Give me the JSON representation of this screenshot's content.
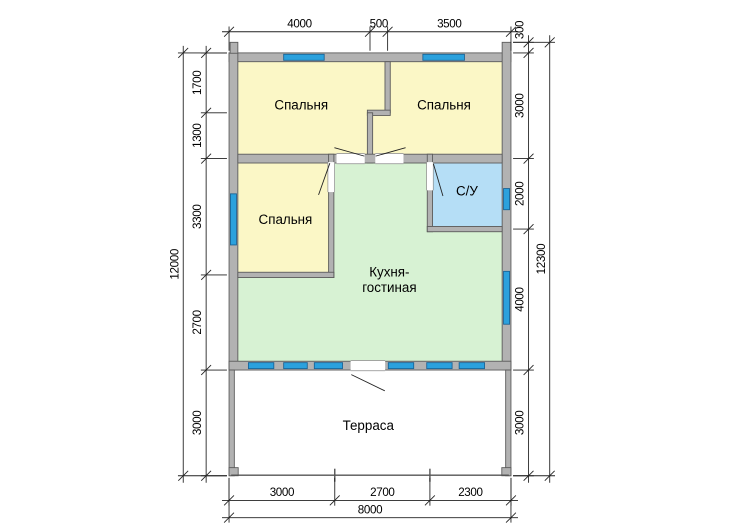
{
  "drawing": {
    "type": "house-floor-plan",
    "units": "mm",
    "colors": {
      "room_yellow": "#fbf7c6",
      "room_green": "#d7f2d3",
      "room_blue": "#b5def6",
      "window_blue": "#2ba1dd",
      "window_outline": "#1a6496",
      "wall_fill": "#b2b2b2",
      "wall_outline": "#5a5a5a",
      "line": "#222222",
      "text": "#000000"
    },
    "rooms": [
      {
        "id": "bedroom-1",
        "label": "Спальня",
        "label_pos": [
          2050,
          1600
        ]
      },
      {
        "id": "bedroom-2",
        "label": "Спальня",
        "label_pos": [
          6100,
          1600
        ]
      },
      {
        "id": "bedroom-3",
        "label": "Спальня",
        "label_pos": [
          1600,
          4850
        ]
      },
      {
        "id": "bathroom",
        "label": "С/У",
        "label_pos": [
          6750,
          4050
        ]
      },
      {
        "id": "kitchen-living",
        "label_lines": [
          "Кухня-",
          "гостиная"
        ],
        "label_pos": [
          4550,
          6350
        ]
      },
      {
        "id": "terrace",
        "label": "Терраса",
        "label_pos": [
          3950,
          10700
        ]
      }
    ],
    "plan": {
      "fills": [
        {
          "name": "bedrooms-top-band",
          "color": "room_yellow",
          "points": "250,250 7750,250 7750,2875 250,2875"
        },
        {
          "name": "bedroom-3",
          "color": "room_yellow",
          "rect": [
            250,
            3125,
            2575,
            3100
          ]
        },
        {
          "name": "kitchen-living",
          "color": "room_green",
          "points": "2975,3125 5625,3125 5625,5075 7750,5075 7750,8750 250,8750 250,6375 2975,6375"
        },
        {
          "name": "bathroom",
          "color": "room_blue",
          "rect": [
            5775,
            3125,
            1975,
            1800
          ]
        }
      ],
      "walls": [
        {
          "rect": [
            0,
            0,
            8000,
            250
          ]
        },
        {
          "rect": [
            0,
            0,
            250,
            9000
          ]
        },
        {
          "rect": [
            7750,
            -300,
            250,
            9300
          ]
        },
        {
          "rect": [
            30,
            -300,
            220,
            310
          ]
        },
        {
          "rect": [
            0,
            8750,
            8000,
            250
          ]
        },
        {
          "rect": [
            4425,
            250,
            150,
            1450
          ]
        },
        {
          "rect": [
            3925,
            1625,
            650,
            150
          ]
        },
        {
          "rect": [
            3925,
            1700,
            150,
            1425
          ]
        },
        {
          "rect": [
            250,
            2875,
            7500,
            250
          ]
        },
        {
          "rect": [
            2825,
            2875,
            150,
            3500
          ]
        },
        {
          "rect": [
            250,
            6225,
            2725,
            150
          ]
        },
        {
          "rect": [
            5625,
            2875,
            150,
            2200
          ]
        },
        {
          "rect": [
            5625,
            4925,
            2125,
            150
          ]
        },
        {
          "rect": [
            0,
            9000,
            150,
            3000
          ]
        },
        {
          "rect": [
            7850,
            9000,
            150,
            3000
          ]
        },
        {
          "rect": [
            0,
            11770,
            260,
            230
          ]
        },
        {
          "rect": [
            7740,
            11770,
            260,
            230
          ]
        }
      ],
      "door_gaps": [
        {
          "rect": [
            3050,
            2855,
            800,
            290
          ]
        },
        {
          "rect": [
            4150,
            2855,
            800,
            290
          ]
        },
        {
          "rect": [
            2805,
            3100,
            190,
            850
          ]
        },
        {
          "rect": [
            5605,
            3100,
            190,
            800
          ]
        },
        {
          "rect": [
            3450,
            8730,
            980,
            290
          ]
        }
      ],
      "windows": [
        {
          "rect": [
            1550,
            40,
            1150,
            170
          ]
        },
        {
          "rect": [
            5500,
            40,
            1180,
            170
          ]
        },
        {
          "rect": [
            40,
            4000,
            170,
            1450
          ]
        },
        {
          "rect": [
            7790,
            3850,
            170,
            600
          ]
        },
        {
          "rect": [
            7790,
            6200,
            170,
            1500
          ]
        },
        {
          "rect": [
            550,
            8790,
            720,
            170
          ]
        },
        {
          "rect": [
            1550,
            8790,
            670,
            170
          ]
        },
        {
          "rect": [
            2420,
            8790,
            800,
            170
          ]
        },
        {
          "rect": [
            4520,
            8790,
            720,
            170
          ]
        },
        {
          "rect": [
            5610,
            8790,
            720,
            170
          ]
        },
        {
          "rect": [
            6530,
            8790,
            720,
            170
          ]
        }
      ],
      "door_swings": [
        {
          "line": [
            2990,
            2690,
            3840,
            2930
          ]
        },
        {
          "line": [
            4160,
            2930,
            5010,
            2690
          ]
        },
        {
          "line": [
            2860,
            3130,
            2540,
            4030
          ]
        },
        {
          "line": [
            5800,
            3150,
            6070,
            4060
          ]
        },
        {
          "line": [
            3470,
            9130,
            4420,
            9590
          ]
        }
      ],
      "terrace": {
        "edge_line": [
          60,
          11985,
          7940,
          11985
        ],
        "post_ticks": [
          3000,
          5700
        ],
        "tick_y": [
          11800,
          12170
        ]
      }
    },
    "dimensions": {
      "chains": [
        {
          "id": "top",
          "axis": "x",
          "line": -600,
          "start": 0,
          "segments": [
            4000,
            500,
            3500
          ],
          "ext_from": -60,
          "ext_to": -750
        },
        {
          "id": "bottom-inner",
          "axis": "x",
          "line": 12700,
          "start": 0,
          "segments": [
            3000,
            2700,
            2300
          ],
          "ext_from": 12060,
          "ext_to": 12850
        },
        {
          "id": "bottom-outer",
          "axis": "x",
          "line": 13190,
          "start": 0,
          "segments": [
            8000
          ],
          "ext_from": 12060,
          "ext_to": 13330
        },
        {
          "id": "left-inner",
          "axis": "y",
          "line": -650,
          "start": 0,
          "segments": [
            1700,
            1300,
            3300,
            2700,
            3000
          ],
          "ext_from": -60,
          "ext_to": -800
        },
        {
          "id": "left-outer",
          "axis": "y",
          "line": -1300,
          "start": 0,
          "segments": [
            12000
          ],
          "ext_from": -60,
          "ext_to": -1450
        },
        {
          "id": "right-inner",
          "axis": "y",
          "line": 8500,
          "start": -300,
          "segments": [
            300,
            3000,
            2000,
            4000,
            3000
          ],
          "ext_from": 8060,
          "ext_to": 8650
        },
        {
          "id": "right-outer",
          "axis": "y",
          "line": 9100,
          "start": -300,
          "segments": [
            12300
          ],
          "ext_from": 8060,
          "ext_to": 9250
        }
      ]
    }
  }
}
